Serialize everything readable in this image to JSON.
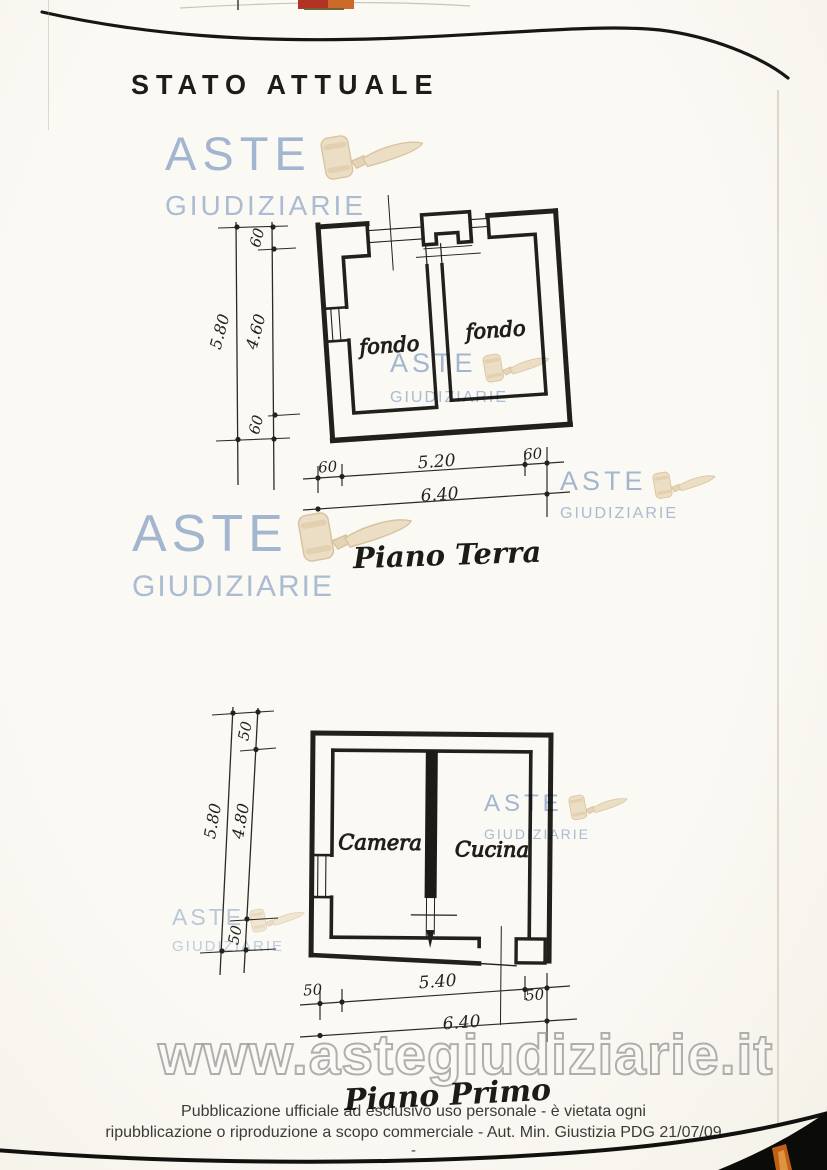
{
  "page": {
    "title": "STATO ATTUALE",
    "footer": {
      "line1": "Pubblicazione ufficiale ad esclusivo uso personale - è vietata ogni",
      "line2": "ripubblicazione o riproduzione a scopo commerciale - Aut. Min. Giustizia PDG 21/07/09",
      "dash": "-"
    }
  },
  "watermark": {
    "brand_top": "ASTE",
    "brand_bottom": "GIUDIZIARIE",
    "url": "www.astegiudiziarie.it",
    "colors": {
      "brand_blue": "#8ea8ce",
      "gavel_beige": "#f0e4ce",
      "url_outline": "#969696"
    }
  },
  "piano_terra": {
    "label": "Piano Terra",
    "room_left": "fondo",
    "room_right": "fondo",
    "dims": {
      "height_total": "5.80",
      "height_wall_top": "60",
      "height_inner": "4.60",
      "height_wall_bottom": "60",
      "width_wall_left": "60",
      "width_inner": "5.20",
      "width_wall_right": "60",
      "width_total": "6.40"
    }
  },
  "piano_primo": {
    "label": "Piano Primo",
    "room_left": "Camera",
    "room_right": "Cucina",
    "dims": {
      "height_total": "5.80",
      "height_wall_top": "50",
      "height_inner": "4.80",
      "height_wall_bottom": "50",
      "width_wall_left": "50",
      "width_inner": "5.40",
      "width_wall_right": "50",
      "width_total": "6.40"
    }
  }
}
